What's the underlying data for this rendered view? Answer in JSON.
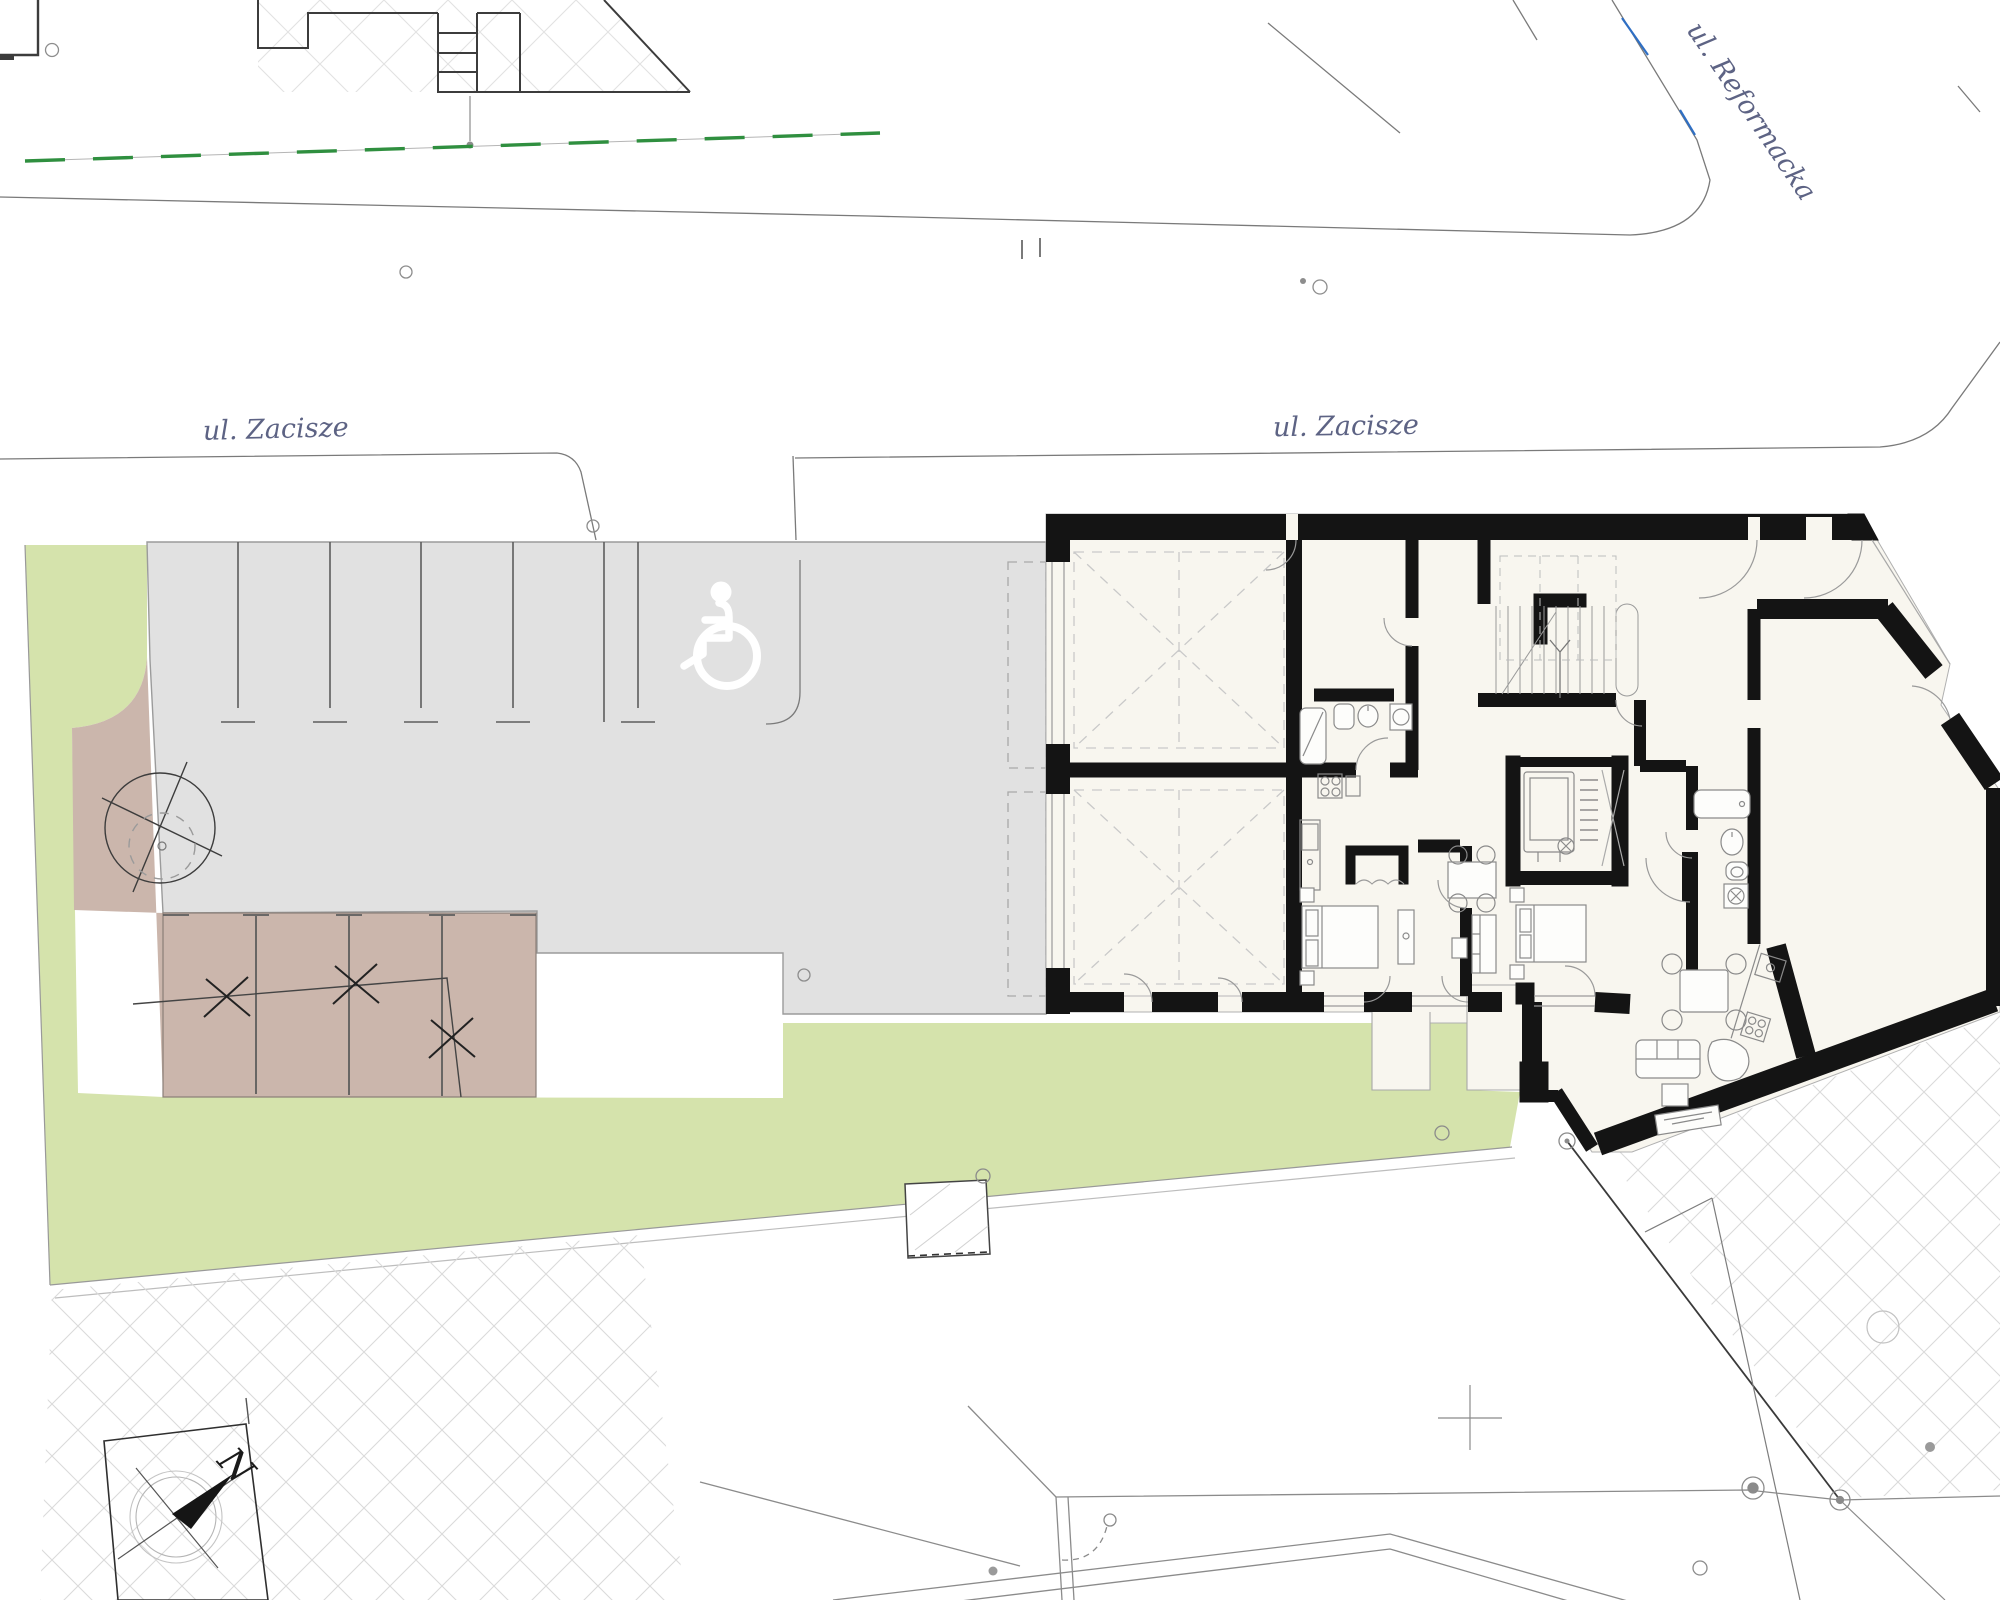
{
  "labels": {
    "street_zacisze_west": "ul. Zacisze",
    "street_zacisze_east": "ul. Zacisze",
    "street_reformacka": "ul. Reformacka",
    "compass_north": "N"
  },
  "icons": {
    "accessible_parking": "wheelchair-icon",
    "north_arrow": "north-compass-icon",
    "tree_marker": "tree-removal-icon"
  },
  "colors": {
    "lawn_green": "#d5e3ac",
    "existing_surface_brown": "#cbb6ac",
    "parking_gray": "#e1e1e1",
    "building_floor_cream": "#f8f6ef",
    "wall_black": "#141414",
    "street_label": "#5d6384",
    "boundary_dash_green": "#2f8f3f",
    "utility_blue": "#2f6fc4",
    "hatch_gray": "#dadada"
  }
}
